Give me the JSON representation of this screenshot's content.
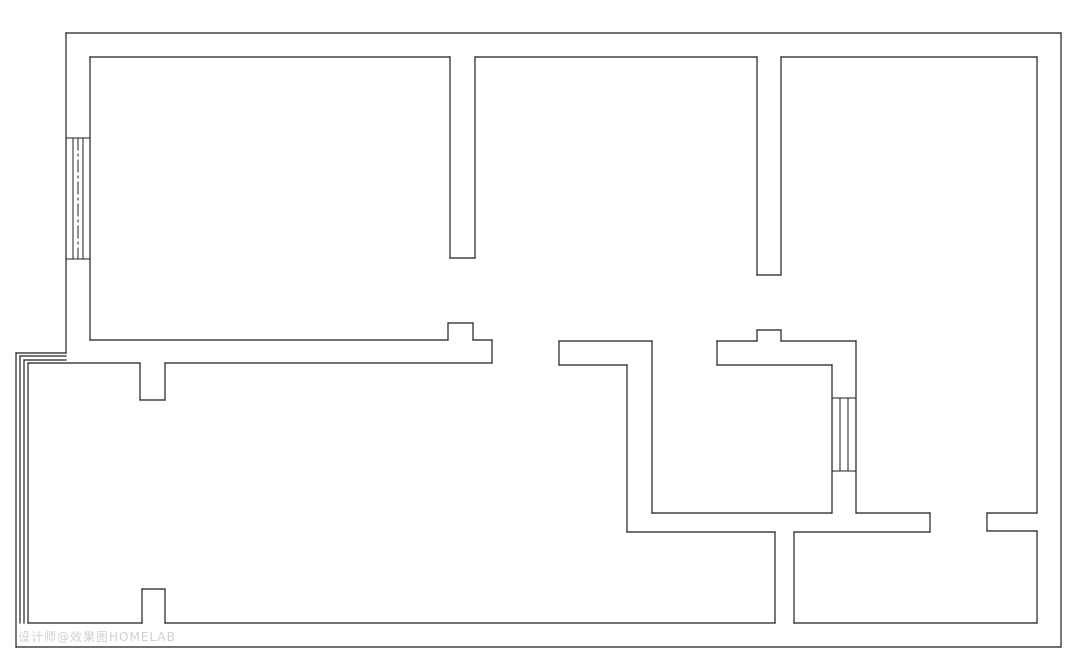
{
  "page": {
    "background_color": "#ffffff",
    "canvas_width": 1080,
    "canvas_height": 665
  },
  "floorplan": {
    "line_color": "#1f1f1f",
    "line_width": 1.2,
    "window_line_width": 1,
    "wall_segments": [
      [
        66,
        33,
        1061,
        33
      ],
      [
        1061,
        33,
        1061,
        647
      ],
      [
        1061,
        647,
        16,
        647
      ],
      [
        16,
        647,
        16,
        353
      ],
      [
        16,
        353,
        66,
        353
      ],
      [
        66,
        353,
        66,
        33
      ],
      [
        90,
        57,
        450,
        57
      ],
      [
        475,
        57,
        757,
        57
      ],
      [
        781,
        57,
        1037,
        57
      ],
      [
        90,
        57,
        90,
        340
      ],
      [
        1037,
        57,
        1037,
        513
      ],
      [
        1037,
        531,
        1037,
        623
      ],
      [
        28,
        623,
        142,
        623
      ],
      [
        165,
        623,
        775,
        623
      ],
      [
        794,
        623,
        1037,
        623
      ],
      [
        20,
        356,
        66,
        356
      ],
      [
        20,
        356,
        20,
        623
      ],
      [
        24,
        360,
        66,
        360
      ],
      [
        24,
        360,
        24,
        623
      ],
      [
        28,
        363,
        28,
        623
      ],
      [
        28,
        363,
        140,
        363
      ],
      [
        165,
        363,
        492,
        363
      ],
      [
        450,
        57,
        450,
        258
      ],
      [
        475,
        57,
        475,
        258
      ],
      [
        450,
        258,
        475,
        258
      ],
      [
        757,
        57,
        757,
        275
      ],
      [
        781,
        57,
        781,
        275
      ],
      [
        757,
        275,
        781,
        275
      ],
      [
        90,
        340,
        448,
        340
      ],
      [
        448,
        340,
        448,
        323
      ],
      [
        448,
        323,
        473,
        323
      ],
      [
        473,
        323,
        473,
        340
      ],
      [
        473,
        340,
        492,
        340
      ],
      [
        492,
        340,
        492,
        363
      ],
      [
        140,
        363,
        140,
        400
      ],
      [
        140,
        400,
        165,
        400
      ],
      [
        165,
        400,
        165,
        363
      ],
      [
        559,
        341,
        652,
        341
      ],
      [
        559,
        341,
        559,
        365
      ],
      [
        559,
        365,
        627,
        365
      ],
      [
        627,
        365,
        627,
        532
      ],
      [
        652,
        341,
        652,
        513
      ],
      [
        652,
        513,
        832,
        513
      ],
      [
        856,
        513,
        930,
        513
      ],
      [
        930,
        513,
        930,
        532
      ],
      [
        930,
        532,
        794,
        532
      ],
      [
        794,
        532,
        794,
        623
      ],
      [
        775,
        623,
        775,
        532
      ],
      [
        775,
        532,
        627,
        532
      ],
      [
        717,
        341,
        757,
        341
      ],
      [
        757,
        341,
        757,
        330
      ],
      [
        757,
        330,
        781,
        330
      ],
      [
        781,
        330,
        781,
        341
      ],
      [
        781,
        341,
        856,
        341
      ],
      [
        717,
        341,
        717,
        365
      ],
      [
        717,
        365,
        832,
        365
      ],
      [
        856,
        341,
        856,
        513
      ],
      [
        832,
        365,
        832,
        513
      ],
      [
        987,
        513,
        1037,
        513
      ],
      [
        987,
        513,
        987,
        531
      ],
      [
        987,
        531,
        1037,
        531
      ],
      [
        142,
        589,
        142,
        623
      ],
      [
        142,
        589,
        165,
        589
      ],
      [
        165,
        589,
        165,
        623
      ]
    ],
    "window_segments": [
      [
        66,
        138,
        90,
        138
      ],
      [
        66,
        259,
        90,
        259
      ],
      [
        73,
        138,
        73,
        259
      ],
      [
        83,
        138,
        83,
        259
      ],
      [
        832,
        398,
        856,
        398
      ],
      [
        832,
        471,
        856,
        471
      ],
      [
        840,
        398,
        840,
        471
      ],
      [
        848,
        398,
        848,
        471
      ]
    ],
    "dashdot_segments": [
      [
        78,
        138,
        78,
        259
      ]
    ],
    "dashdot_pattern": "12 4 2 4"
  },
  "watermark": {
    "text": "设计师@效果图HOMELAB",
    "color": "#8f8f8f"
  }
}
